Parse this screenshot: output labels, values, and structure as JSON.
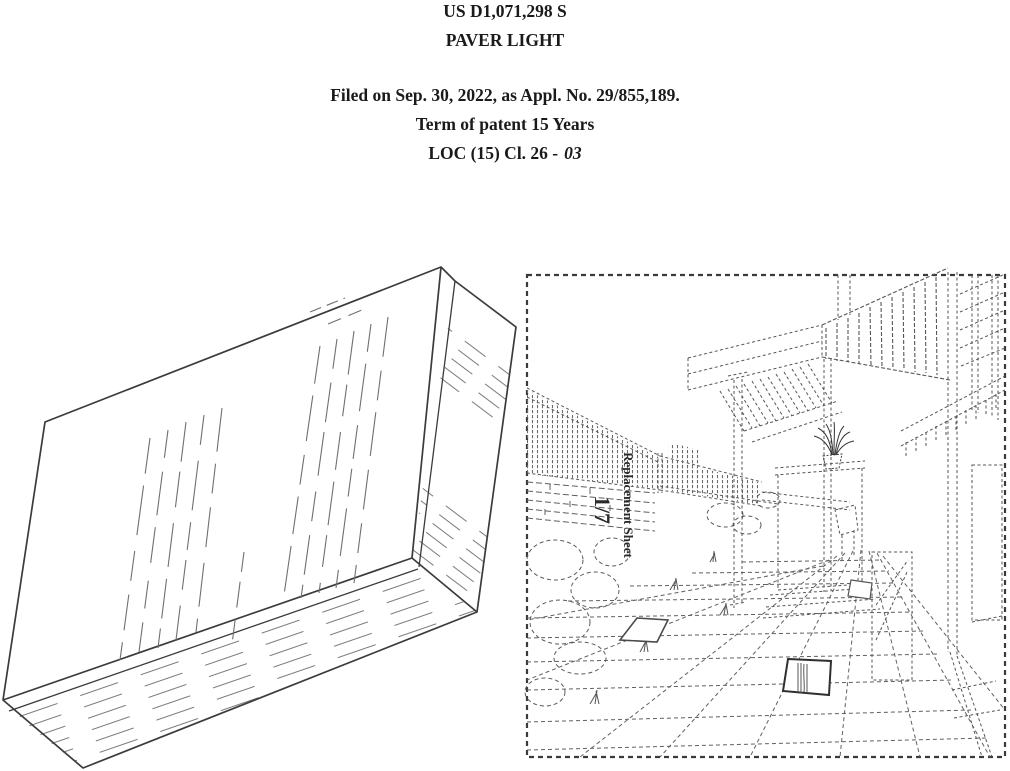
{
  "header": {
    "patent_number": "US D1,071,298 S",
    "title": "PAVER LIGHT",
    "filed": "Filed on Sep. 30, 2022, as Appl. No. 29/855,189.",
    "term": "Term of patent 15 Years",
    "loc_prefix": "LOC (15) Cl. 26 -",
    "loc_class": "03"
  },
  "figures": {
    "environment": {
      "sheet_label": "Replacement Sheet",
      "sheet_number": "1/7"
    }
  }
}
